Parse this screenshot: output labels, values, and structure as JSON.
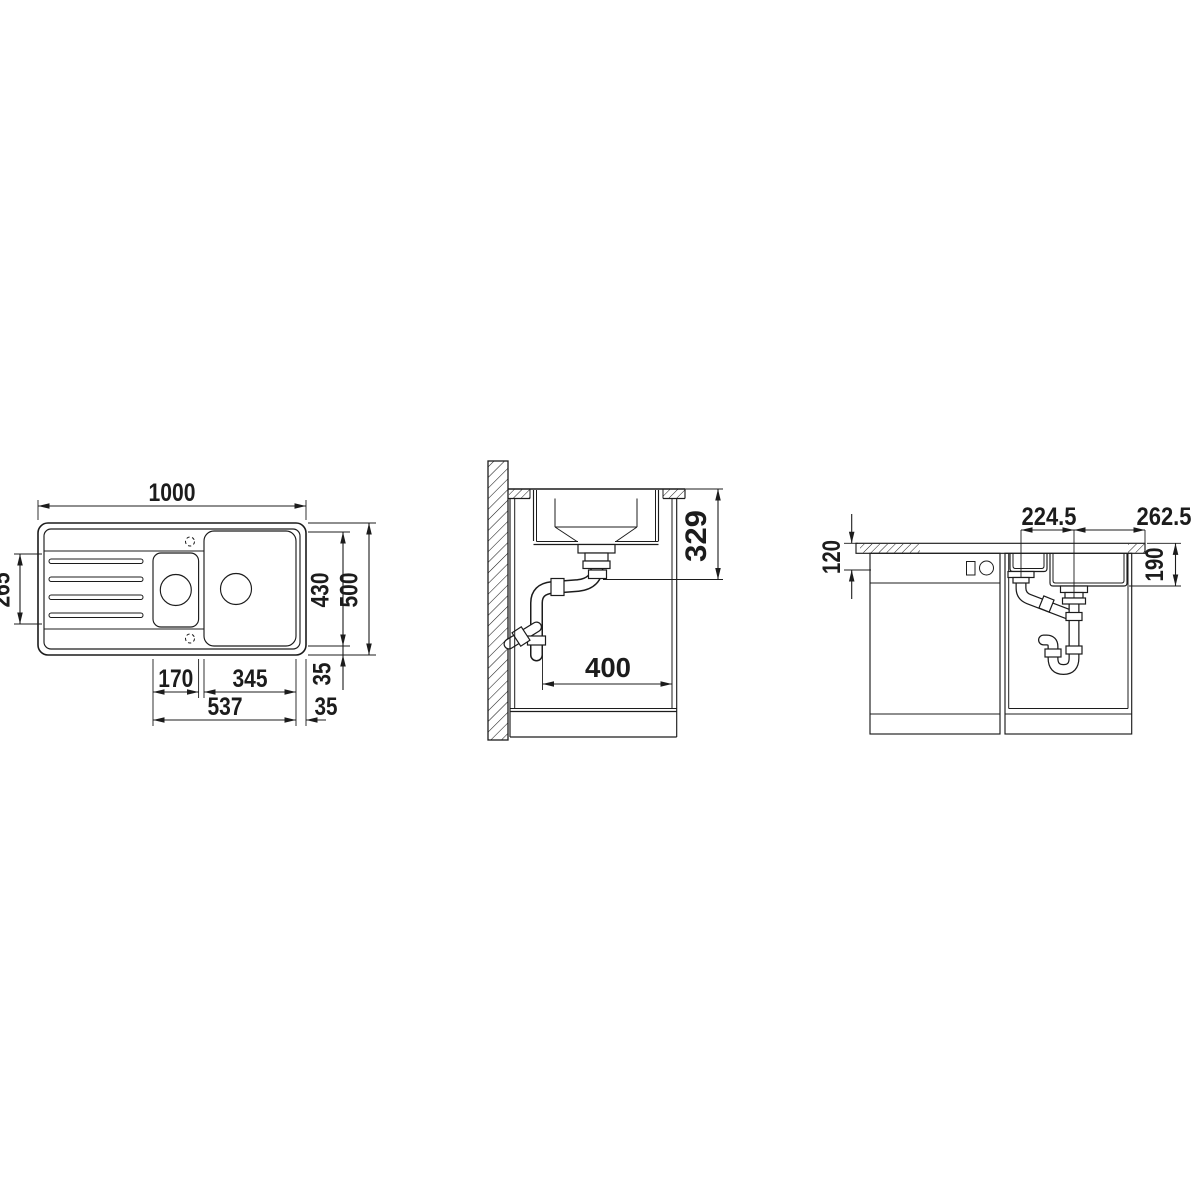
{
  "drawing": {
    "type": "sink-installation-dimension-drawing",
    "line_color": "#1c1c1c",
    "background_color": "#ffffff"
  },
  "views": {
    "top": {
      "name": "top-view",
      "dims": {
        "overall_width": "1000",
        "overall_depth": "500",
        "inner_depth": "430",
        "drainer_length": "265",
        "small_bowl_width": "170",
        "main_bowl_width": "345",
        "bowls_span": "537",
        "rim_back": "35",
        "rim_side": "35"
      }
    },
    "section": {
      "name": "section-view",
      "dims": {
        "outlet_height": "329",
        "clearance_depth": "400"
      }
    },
    "front": {
      "name": "front-view",
      "dims": {
        "front_height": "120",
        "bowl_depth": "190",
        "drain_spacing": "224.5",
        "drain_to_edge": "262.5"
      }
    }
  }
}
